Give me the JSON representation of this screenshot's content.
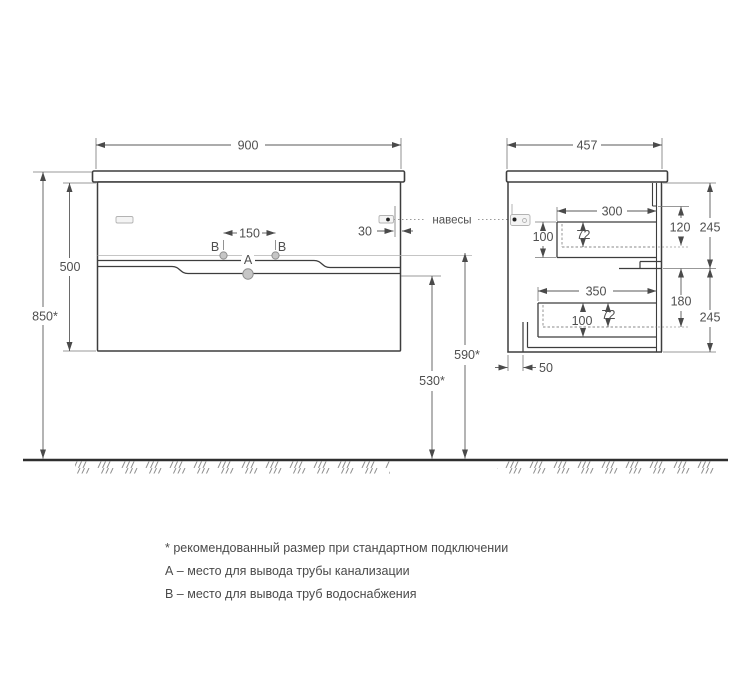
{
  "drawing": {
    "front_view": {
      "width": "900",
      "body_height": "500",
      "total_height": "850*",
      "drain_outlet_height": "590*",
      "water_outlet_height": "530*",
      "outlet_spacing": "150",
      "hanger_offset": "30",
      "label_a": "A",
      "label_b_left": "B",
      "label_b_right": "B",
      "hangers_callout": "навесы"
    },
    "side_view": {
      "depth": "457",
      "top_drawer": {
        "width": "300",
        "height": "100",
        "inner_height": "72"
      },
      "bottom_drawer": {
        "width": "350",
        "height": "100",
        "inner_height": "72"
      },
      "rail_to_shelf": "120",
      "top_section_height": "245",
      "shelf_to_drawer": "180",
      "bottom_section_height": "245",
      "back_clearance": "50"
    },
    "legend": {
      "note_asterisk": "* рекомендованный размер при стандартном подключении",
      "note_a": "А – место для вывода трубы канализации",
      "note_b": "В – место для вывода труб водоснабжения"
    },
    "colors": {
      "line": "#3d3d3d",
      "dim": "#5a5a5a",
      "text": "#4f4f4f",
      "ground": "#2e2e2e"
    }
  }
}
